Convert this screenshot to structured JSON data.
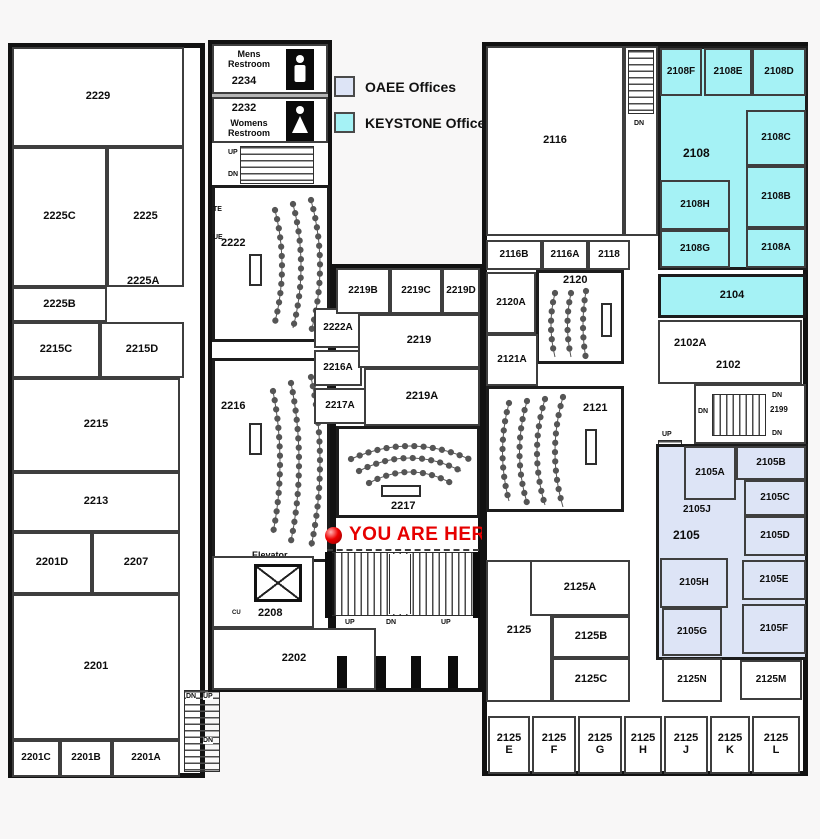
{
  "legend": {
    "items": [
      {
        "id": "oaee",
        "label": "OAEE Offices",
        "color": "#dde4f6"
      },
      {
        "id": "keystone",
        "label": "KEYSTONE Offices",
        "color": "#a5f2f5"
      }
    ]
  },
  "marker": {
    "label": "YOU ARE HERE",
    "color": "#e60000"
  },
  "labels": {
    "mens_restroom": "Mens\nRestroom",
    "womens_restroom": "Womens\nRestroom",
    "elevator": "Elevator",
    "up": "UP",
    "dn": "DN",
    "cu": "CU",
    "te": "TE",
    "ue": "UE",
    "hvac": "HVAC"
  },
  "rooms": {
    "2229": "2229",
    "2225": "2225",
    "2225A": "2225A",
    "2225B": "2225B",
    "2225C": "2225C",
    "2215": "2215",
    "2215C": "2215C",
    "2215D": "2215D",
    "2213": "2213",
    "2201": "2201",
    "2201A": "2201A",
    "2201B": "2201B",
    "2201C": "2201C",
    "2201D": "2201D",
    "2207": "2207",
    "2234": "2234",
    "2232": "2232",
    "2222": "2222",
    "2222A": "2222A",
    "2216": "2216",
    "2216A": "2216A",
    "2217": "2217",
    "2217A": "2217A",
    "2219": "2219",
    "2219A": "2219A",
    "2219B": "2219B",
    "2219C": "2219C",
    "2219D": "2219D",
    "2208": "2208",
    "2202": "2202",
    "2116": "2116",
    "2116A": "2116A",
    "2116B": "2116B",
    "2118": "2118",
    "2120": "2120",
    "2120A": "2120A",
    "2121": "2121",
    "2121A": "2121A",
    "2108": "2108",
    "2108A": "2108A",
    "2108B": "2108B",
    "2108C": "2108C",
    "2108D": "2108D",
    "2108E": "2108E",
    "2108F": "2108F",
    "2108G": "2108G",
    "2108H": "2108H",
    "2104": "2104",
    "2102": "2102",
    "2102A": "2102A",
    "2199": "2199",
    "2105": "2105",
    "2105A": "2105A",
    "2105B": "2105B",
    "2105C": "2105C",
    "2105D": "2105D",
    "2105E": "2105E",
    "2105F": "2105F",
    "2105G": "2105G",
    "2105H": "2105H",
    "2105J": "2105J",
    "2125": "2125",
    "2125A": "2125A",
    "2125B": "2125B",
    "2125C": "2125C",
    "2125M": "2125M",
    "2125N": "2125N",
    "2125E": "2125\nE",
    "2125F": "2125\nF",
    "2125G": "2125\nG",
    "2125H": "2125\nH",
    "2125J": "2125\nJ",
    "2125K": "2125\nK",
    "2125L": "2125\nL"
  }
}
